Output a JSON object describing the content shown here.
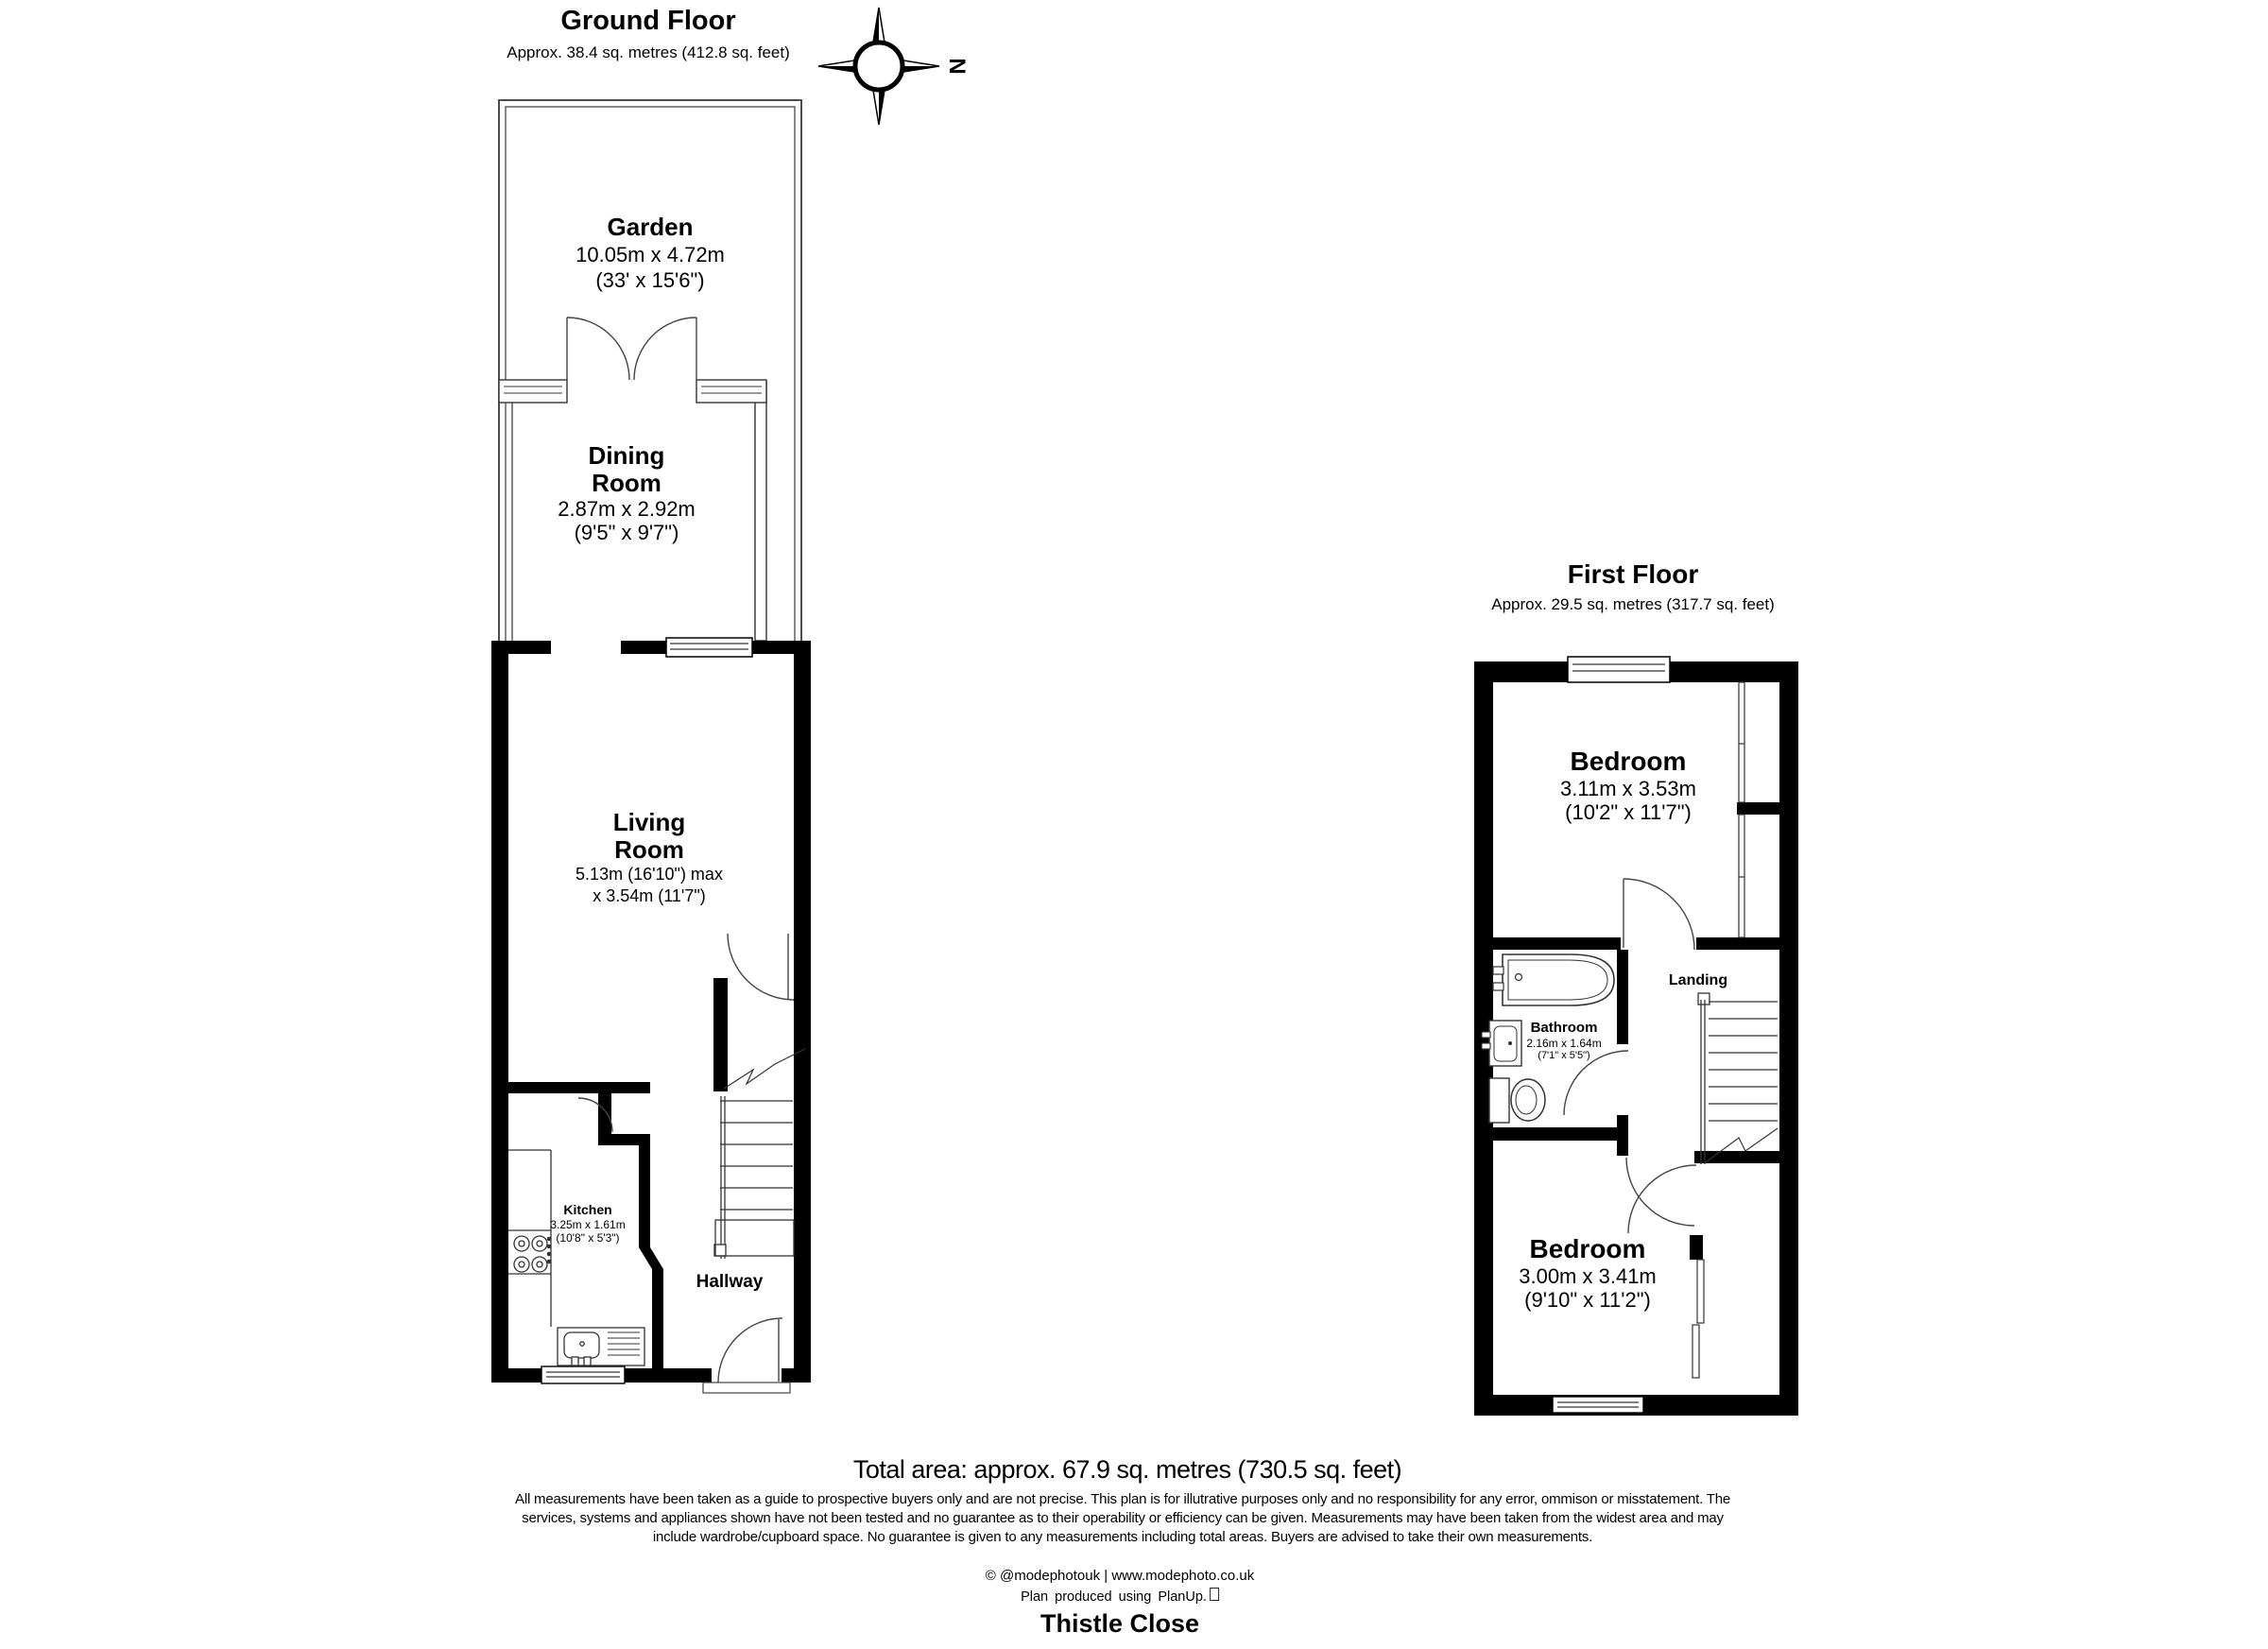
{
  "compass": {
    "label": "N"
  },
  "ground_floor": {
    "title": "Ground Floor",
    "area": "Approx. 38.4 sq. metres (412.8 sq. feet)",
    "garden": {
      "name": "Garden",
      "dims_metric": "10.05m x 4.72m",
      "dims_imperial": "(33' x 15'6\")"
    },
    "dining_room": {
      "name_line1": "Dining",
      "name_line2": "Room",
      "dims_metric": "2.87m x 2.92m",
      "dims_imperial": "(9'5\" x 9'7\")"
    },
    "living_room": {
      "name_line1": "Living",
      "name_line2": "Room",
      "dims_line1": "5.13m (16'10\") max",
      "dims_line2": "x 3.54m (11'7\")"
    },
    "kitchen": {
      "name": "Kitchen",
      "dims_metric": "3.25m x 1.61m",
      "dims_imperial": "(10'8\" x 5'3\")"
    },
    "hallway": {
      "name": "Hallway"
    }
  },
  "first_floor": {
    "title": "First Floor",
    "area": "Approx. 29.5 sq. metres (317.7 sq. feet)",
    "bedroom_front": {
      "name": "Bedroom",
      "dims_metric": "3.11m x 3.53m",
      "dims_imperial": "(10'2\" x 11'7\")"
    },
    "bathroom": {
      "name": "Bathroom",
      "dims_metric": "2.16m x 1.64m",
      "dims_imperial": "(7'1\" x 5'5\")"
    },
    "landing": {
      "name": "Landing"
    },
    "bedroom_back": {
      "name": "Bedroom",
      "dims_metric": "3.00m x 3.41m",
      "dims_imperial": "(9'10\" x 11'2\")"
    }
  },
  "summary": {
    "total_area": "Total area: approx. 67.9 sq. metres (730.5 sq. feet)"
  },
  "disclaimer": {
    "line1": "All measurements have been taken as a guide to prospective buyers only and are not precise. This plan is for illutrative purposes only and no responsibility for any error, ommison or misstatement. The",
    "line2": "services, systems and appliances shown have not been tested and no guarantee as to their operability or efficiency can be given. Measurements may have been taken from the widest area and may",
    "line3": "include wardrobe/cupboard space. No guarantee is given to any measurements including total areas. Buyers are advised to take their own measurements."
  },
  "footer": {
    "credit": "© @modephotouk | www.modephoto.co.uk",
    "produced": "Plan produced using PlanUp.",
    "property_name": "Thistle Close"
  }
}
